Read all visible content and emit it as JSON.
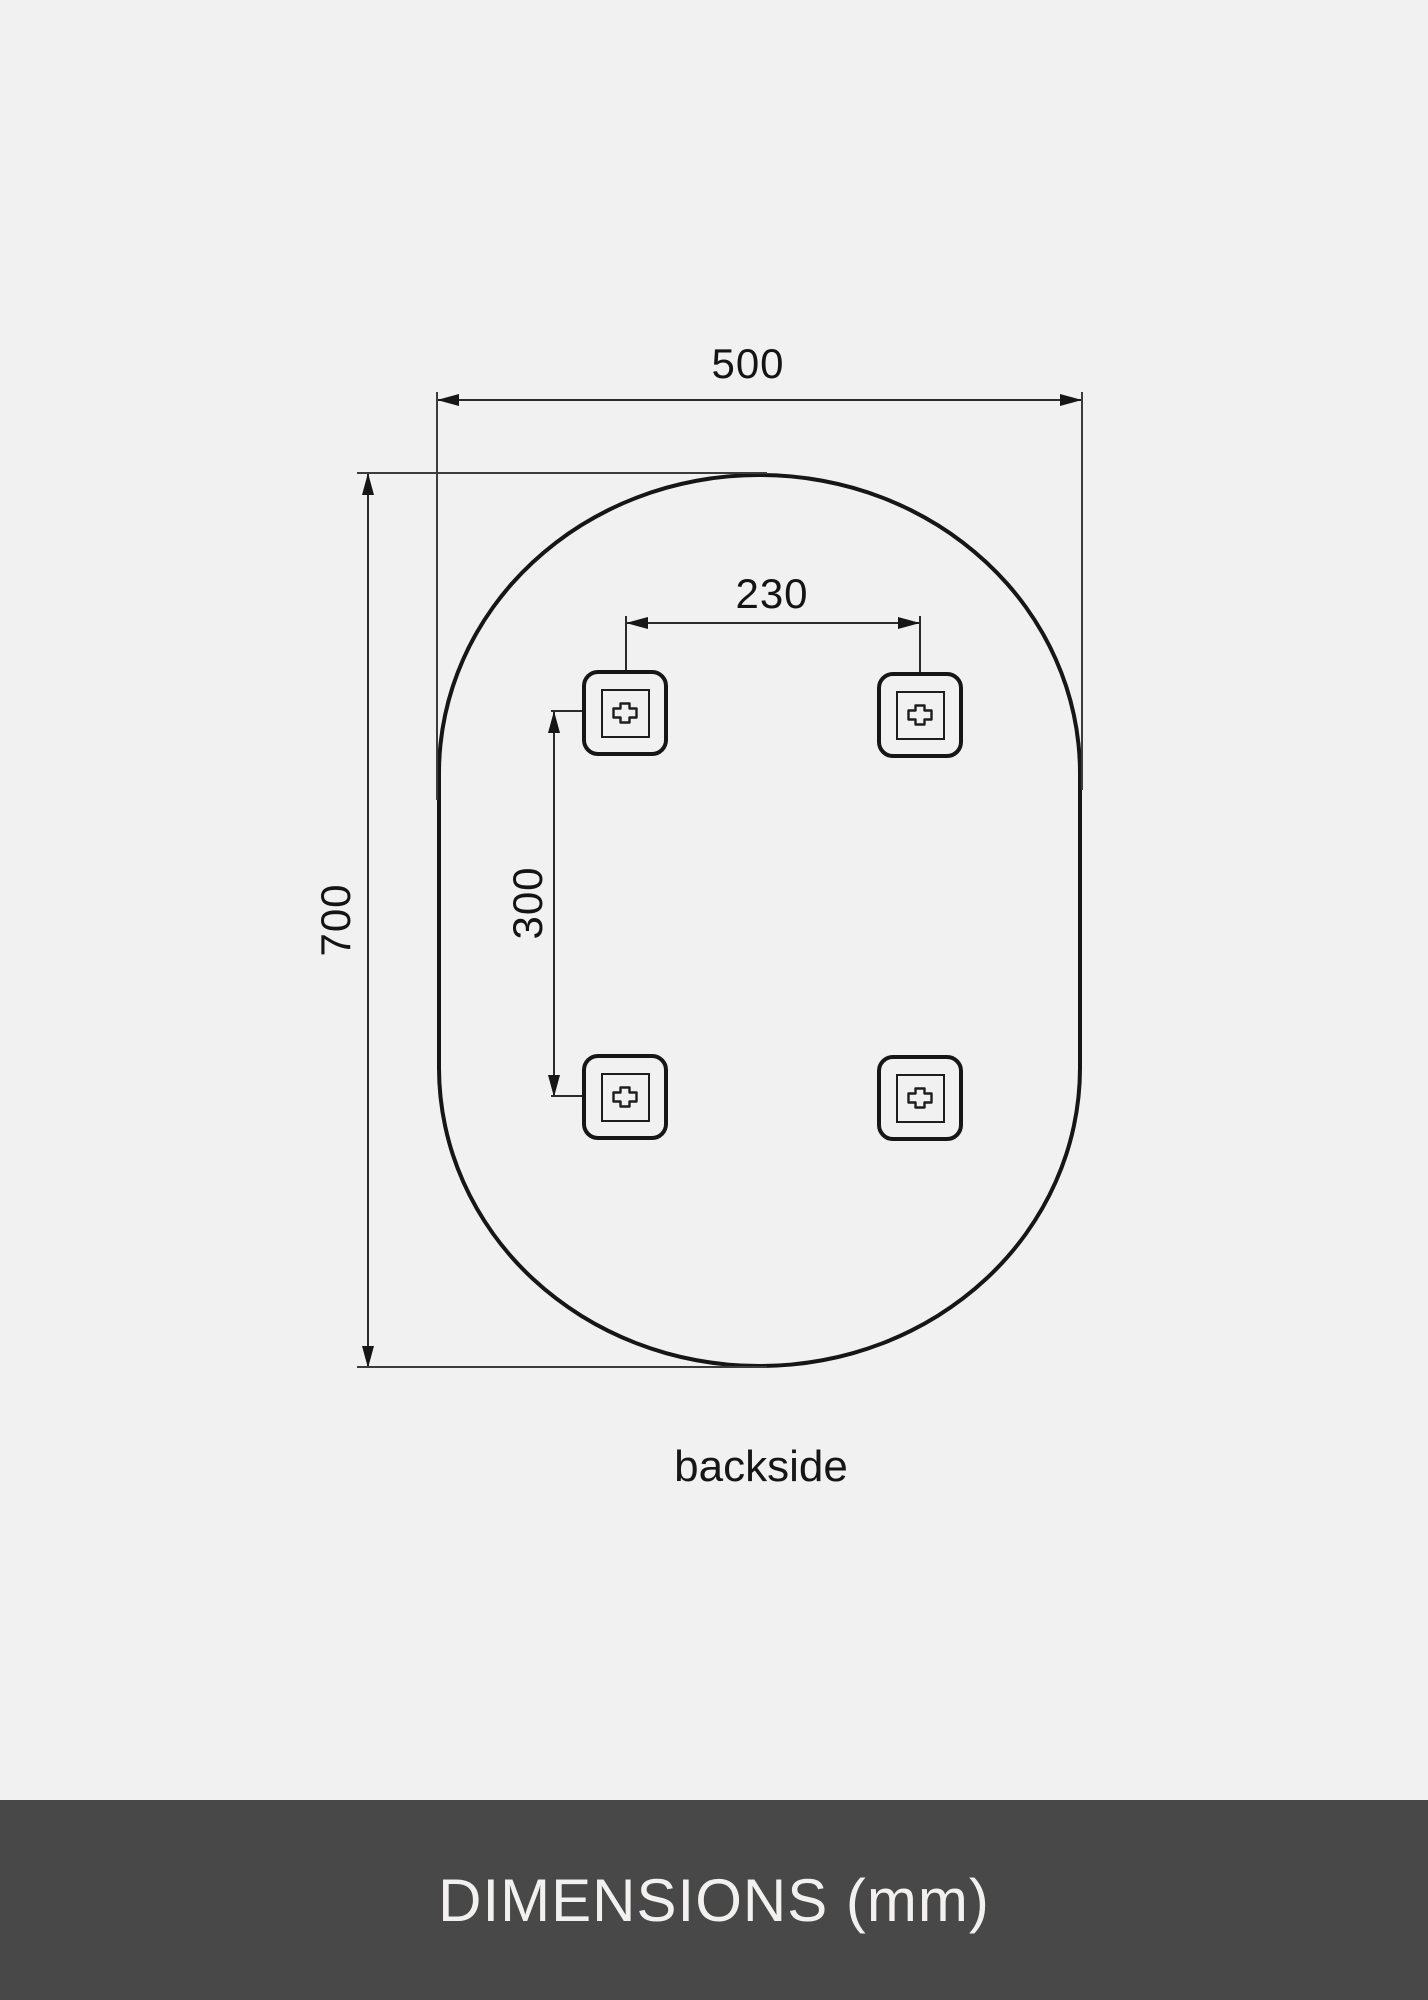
{
  "diagram": {
    "view_label": "backside",
    "unit": "mm",
    "mirror": {
      "shape": "pill-oval",
      "outline_color": "#161616",
      "background_color": "#f1f1f1"
    },
    "dimensions": {
      "width": {
        "value": "500",
        "orientation": "horizontal"
      },
      "height": {
        "value": "700",
        "orientation": "vertical"
      },
      "bracket_spacing_horizontal": {
        "value": "230",
        "orientation": "horizontal"
      },
      "bracket_spacing_vertical": {
        "value": "300",
        "orientation": "vertical"
      }
    },
    "brackets": {
      "count": 4,
      "icon": "plus-icon"
    }
  },
  "footer": {
    "title": "DIMENSIONS (mm)",
    "background_color": "#484848",
    "text_color": "#f2f1ef"
  }
}
